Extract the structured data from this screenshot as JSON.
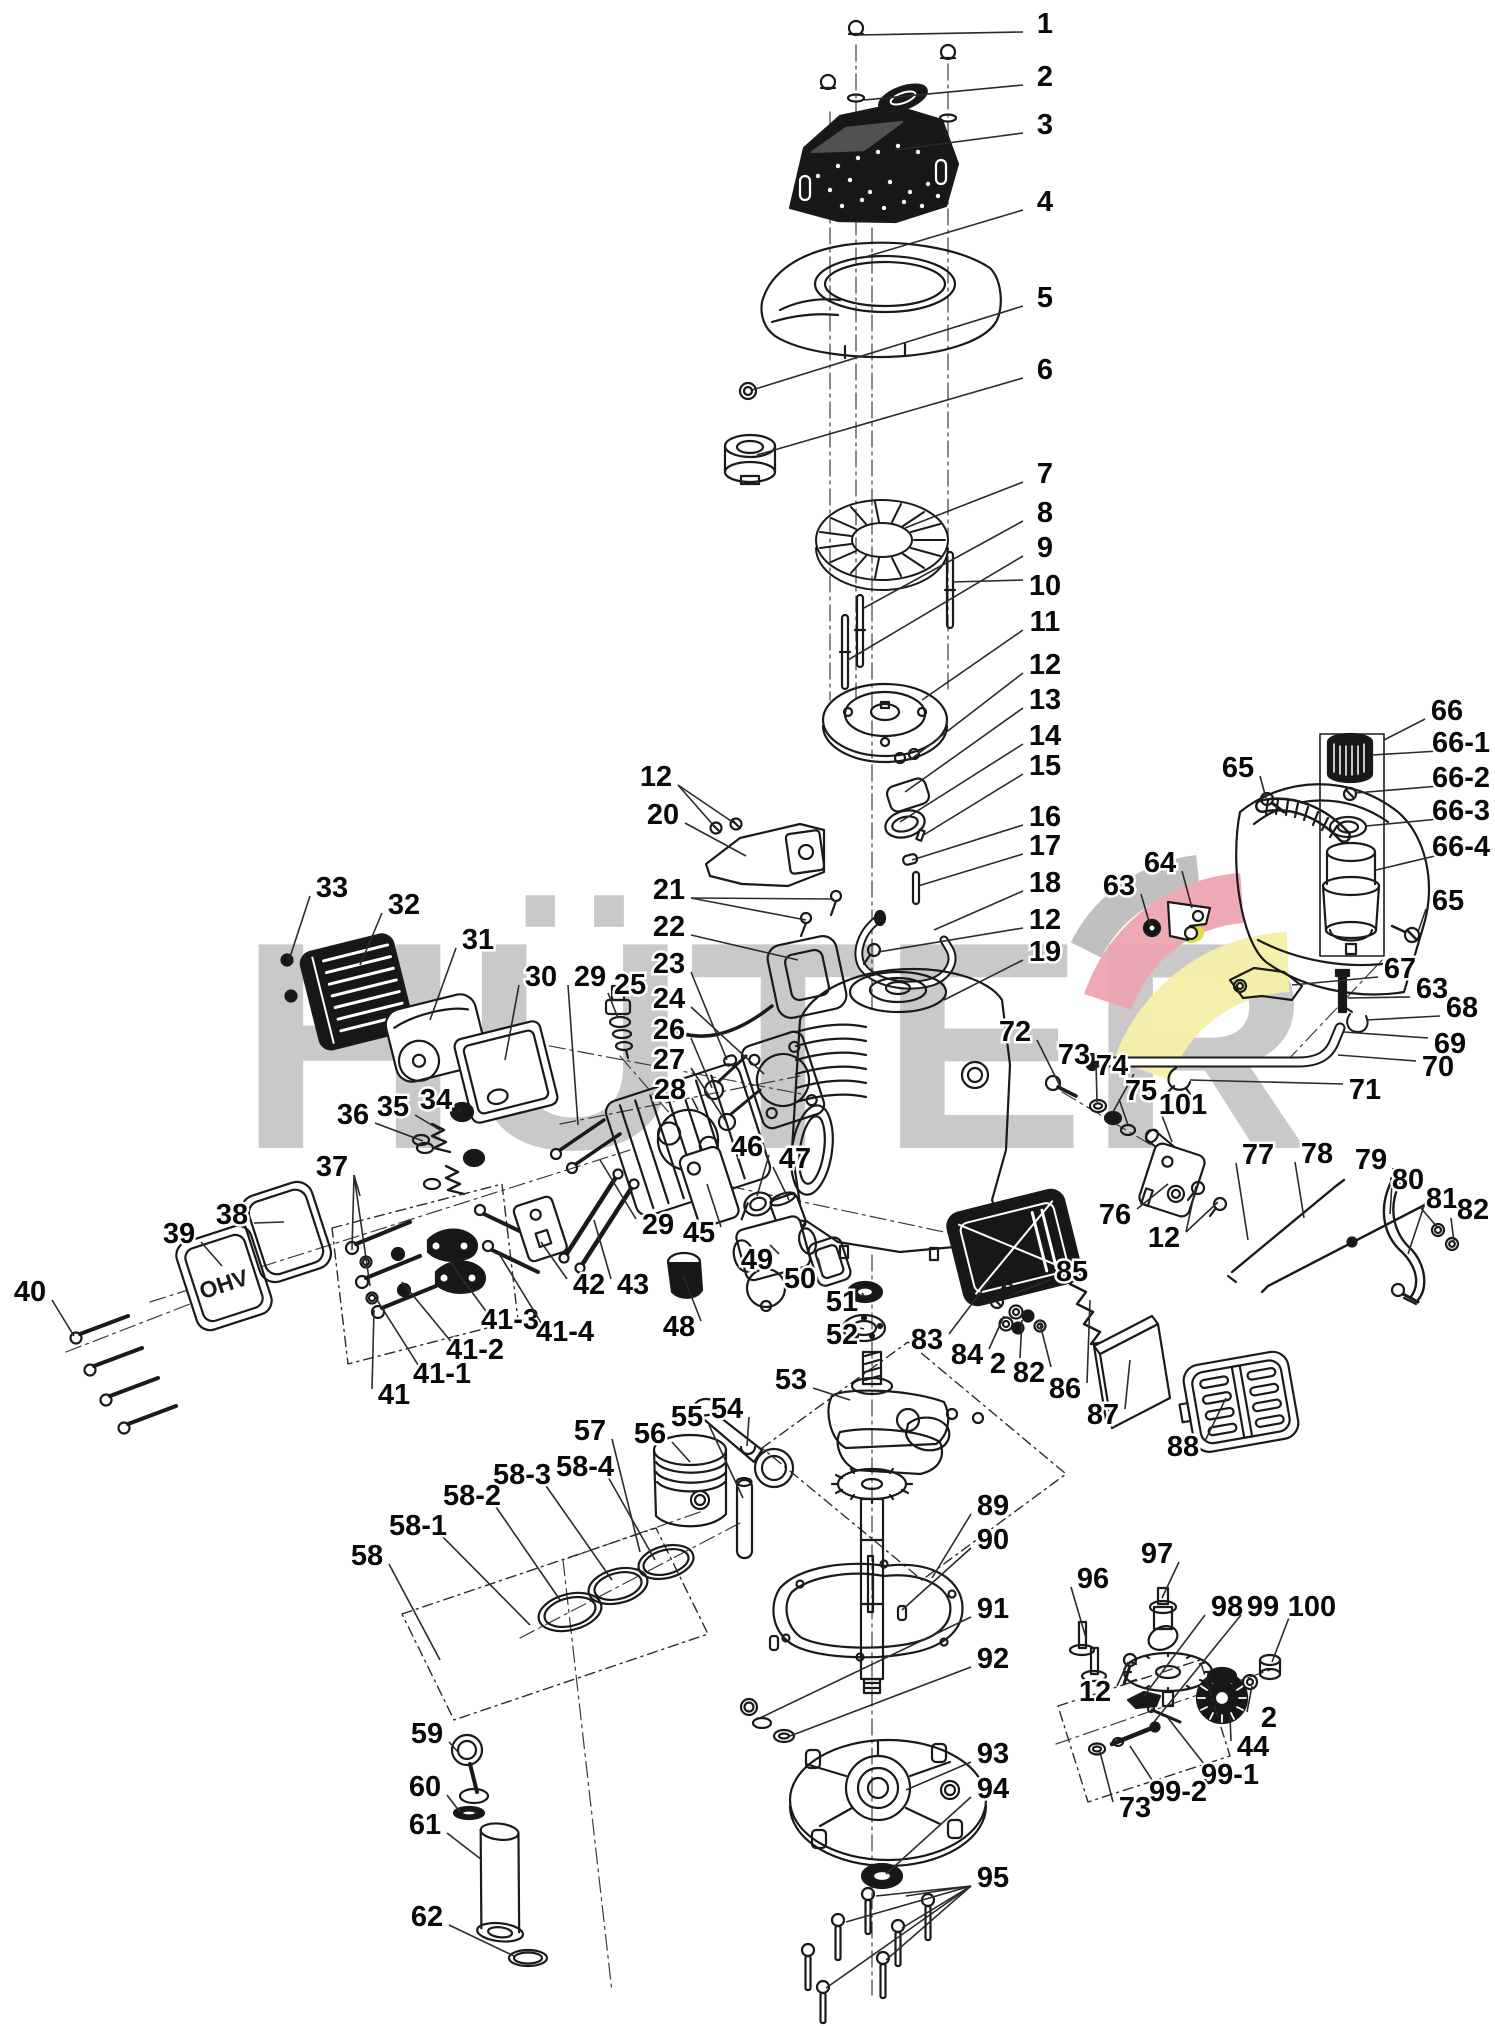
{
  "page": {
    "type": "exploded-parts-diagram",
    "subject": "engine"
  },
  "watermark": {
    "text": "HÜTER",
    "text_color": "#c9c9c9",
    "swoosh_gray": "#bdbdbd",
    "swoosh_red": "#eda6b0",
    "swoosh_yellow": "#f6f0a8",
    "highlight_yellow": "#d9de4b"
  },
  "engraving": {
    "valve_cover": "OHV"
  },
  "style": {
    "ink": "#1a1a1a",
    "background": "#ffffff"
  },
  "labels": [
    {
      "n": "1",
      "x": 1045,
      "y": 22,
      "l": [
        [
          856,
          35
        ]
      ]
    },
    {
      "n": "2",
      "x": 1045,
      "y": 75,
      "l": [
        [
          864,
          100
        ]
      ]
    },
    {
      "n": "3",
      "x": 1045,
      "y": 123,
      "l": [
        [
          895,
          150
        ]
      ]
    },
    {
      "n": "4",
      "x": 1045,
      "y": 200,
      "l": [
        [
          862,
          258
        ]
      ]
    },
    {
      "n": "5",
      "x": 1045,
      "y": 296,
      "l": [
        [
          752,
          390
        ]
      ]
    },
    {
      "n": "6",
      "x": 1045,
      "y": 368,
      "l": [
        [
          757,
          455
        ]
      ]
    },
    {
      "n": "7",
      "x": 1045,
      "y": 472,
      "l": [
        [
          905,
          528
        ]
      ]
    },
    {
      "n": "8",
      "x": 1045,
      "y": 511,
      "l": [
        [
          864,
          608
        ]
      ]
    },
    {
      "n": "9",
      "x": 1045,
      "y": 546,
      "l": [
        [
          848,
          660
        ]
      ]
    },
    {
      "n": "10",
      "x": 1045,
      "y": 584,
      "l": [
        [
          952,
          582
        ]
      ]
    },
    {
      "n": "11",
      "x": 1045,
      "y": 620,
      "l": [
        [
          922,
          700
        ]
      ]
    },
    {
      "n": "12",
      "x": 1045,
      "y": 663,
      "l": [
        [
          910,
          760
        ]
      ]
    },
    {
      "n": "13",
      "x": 1045,
      "y": 698,
      "l": [
        [
          905,
          792
        ]
      ]
    },
    {
      "n": "14",
      "x": 1045,
      "y": 734,
      "l": [
        [
          900,
          822
        ]
      ]
    },
    {
      "n": "15",
      "x": 1045,
      "y": 764,
      "l": [
        [
          922,
          836
        ]
      ]
    },
    {
      "n": "16",
      "x": 1045,
      "y": 815,
      "l": [
        [
          912,
          860
        ]
      ]
    },
    {
      "n": "17",
      "x": 1045,
      "y": 844,
      "l": [
        [
          918,
          886
        ]
      ]
    },
    {
      "n": "18",
      "x": 1045,
      "y": 881,
      "l": [
        [
          934,
          930
        ]
      ]
    },
    {
      "n": "12",
      "x": 1045,
      "y": 918,
      "l": [
        [
          878,
          952
        ]
      ]
    },
    {
      "n": "19",
      "x": 1045,
      "y": 950,
      "l": [
        [
          944,
          1000
        ]
      ]
    },
    {
      "n": "12",
      "x": 656,
      "y": 775,
      "l": [
        [
          714,
          826
        ],
        [
          734,
          823
        ]
      ]
    },
    {
      "n": "20",
      "x": 663,
      "y": 813,
      "l": [
        [
          746,
          856
        ]
      ]
    },
    {
      "n": "21",
      "x": 669,
      "y": 888,
      "l": [
        [
          834,
          899
        ],
        [
          806,
          920
        ]
      ]
    },
    {
      "n": "22",
      "x": 669,
      "y": 925,
      "l": [
        [
          798,
          960
        ]
      ]
    },
    {
      "n": "23",
      "x": 669,
      "y": 962,
      "l": [
        [
          727,
          1060
        ]
      ]
    },
    {
      "n": "24",
      "x": 669,
      "y": 997,
      "l": [
        [
          764,
          1074
        ]
      ]
    },
    {
      "n": "26",
      "x": 669,
      "y": 1028,
      "l": [
        [
          712,
          1088
        ]
      ]
    },
    {
      "n": "27",
      "x": 669,
      "y": 1058,
      "l": [
        [
          725,
          1120
        ]
      ]
    },
    {
      "n": "28",
      "x": 670,
      "y": 1088,
      "l": [
        [
          698,
          1110
        ]
      ]
    },
    {
      "n": "25",
      "x": 630,
      "y": 983,
      "l": [
        [
          618,
          1018
        ]
      ]
    },
    {
      "n": "29",
      "x": 590,
      "y": 975,
      "l": [
        [
          578,
          1125
        ]
      ]
    },
    {
      "n": "30",
      "x": 541,
      "y": 975,
      "l": [
        [
          505,
          1060
        ]
      ]
    },
    {
      "n": "31",
      "x": 478,
      "y": 938,
      "l": [
        [
          430,
          1020
        ]
      ]
    },
    {
      "n": "32",
      "x": 404,
      "y": 903,
      "l": [
        [
          360,
          965
        ]
      ]
    },
    {
      "n": "33",
      "x": 332,
      "y": 886,
      "l": [
        [
          289,
          960
        ]
      ]
    },
    {
      "n": "34",
      "x": 436,
      "y": 1098,
      "l": [
        [
          461,
          1112
        ]
      ]
    },
    {
      "n": "35",
      "x": 393,
      "y": 1105,
      "l": [
        [
          440,
          1130
        ]
      ]
    },
    {
      "n": "36",
      "x": 353,
      "y": 1113,
      "l": [
        [
          423,
          1141
        ]
      ]
    },
    {
      "n": "37",
      "x": 332,
      "y": 1165,
      "l": [
        [
          360,
          1196
        ],
        [
          352,
          1250
        ],
        [
          370,
          1286
        ]
      ]
    },
    {
      "n": "38",
      "x": 232,
      "y": 1213,
      "l": [
        [
          284,
          1222
        ]
      ]
    },
    {
      "n": "39",
      "x": 179,
      "y": 1232,
      "l": [
        [
          222,
          1266
        ]
      ]
    },
    {
      "n": "40",
      "x": 30,
      "y": 1290,
      "l": [
        [
          74,
          1336
        ]
      ]
    },
    {
      "n": "41",
      "x": 394,
      "y": 1393,
      "l": [
        [
          374,
          1310
        ]
      ]
    },
    {
      "n": "41-1",
      "x": 442,
      "y": 1372,
      "l": [
        [
          372,
          1292
        ]
      ]
    },
    {
      "n": "41-2",
      "x": 475,
      "y": 1348,
      "l": [
        [
          402,
          1282
        ]
      ]
    },
    {
      "n": "41-3",
      "x": 510,
      "y": 1318,
      "l": [
        [
          450,
          1262
        ]
      ]
    },
    {
      "n": "41-4",
      "x": 565,
      "y": 1330,
      "l": [
        [
          498,
          1252
        ]
      ]
    },
    {
      "n": "42",
      "x": 589,
      "y": 1283,
      "l": [
        [
          541,
          1242
        ]
      ]
    },
    {
      "n": "43",
      "x": 633,
      "y": 1283,
      "l": [
        [
          594,
          1220
        ]
      ]
    },
    {
      "n": "29",
      "x": 658,
      "y": 1223,
      "l": [
        [
          600,
          1160
        ]
      ]
    },
    {
      "n": "45",
      "x": 699,
      "y": 1231,
      "l": [
        [
          707,
          1184
        ]
      ]
    },
    {
      "n": "46",
      "x": 747,
      "y": 1145,
      "l": [
        [
          757,
          1196
        ]
      ]
    },
    {
      "n": "47",
      "x": 795,
      "y": 1157,
      "l": [
        [
          789,
          1200
        ]
      ]
    },
    {
      "n": "48",
      "x": 679,
      "y": 1325,
      "l": [
        [
          683,
          1275
        ]
      ]
    },
    {
      "n": "49",
      "x": 757,
      "y": 1258,
      "l": [
        [
          770,
          1245
        ]
      ]
    },
    {
      "n": "50",
      "x": 800,
      "y": 1277,
      "l": [
        [
          818,
          1258
        ]
      ]
    },
    {
      "n": "51",
      "x": 842,
      "y": 1300,
      "l": [
        [
          862,
          1293
        ]
      ]
    },
    {
      "n": "52",
      "x": 842,
      "y": 1333,
      "l": [
        [
          860,
          1328
        ]
      ]
    },
    {
      "n": "53",
      "x": 791,
      "y": 1378,
      "l": [
        [
          850,
          1400
        ]
      ]
    },
    {
      "n": "54",
      "x": 727,
      "y": 1407,
      "l": [
        [
          747,
          1446
        ]
      ]
    },
    {
      "n": "55",
      "x": 687,
      "y": 1415,
      "l": [
        [
          743,
          1498
        ]
      ]
    },
    {
      "n": "56",
      "x": 650,
      "y": 1432,
      "l": [
        [
          690,
          1462
        ]
      ]
    },
    {
      "n": "57",
      "x": 590,
      "y": 1429,
      "l": [
        [
          640,
          1552
        ]
      ]
    },
    {
      "n": "58-4",
      "x": 585,
      "y": 1465,
      "l": [
        [
          655,
          1560
        ]
      ]
    },
    {
      "n": "58-3",
      "x": 522,
      "y": 1473,
      "l": [
        [
          612,
          1580
        ]
      ]
    },
    {
      "n": "58-2",
      "x": 472,
      "y": 1494,
      "l": [
        [
          560,
          1600
        ]
      ]
    },
    {
      "n": "58-1",
      "x": 418,
      "y": 1524,
      "l": [
        [
          530,
          1625
        ]
      ]
    },
    {
      "n": "58",
      "x": 367,
      "y": 1554,
      "l": [
        [
          440,
          1660
        ]
      ]
    },
    {
      "n": "59",
      "x": 427,
      "y": 1732,
      "l": [
        [
          458,
          1752
        ]
      ]
    },
    {
      "n": "60",
      "x": 425,
      "y": 1785,
      "l": [
        [
          460,
          1812
        ]
      ]
    },
    {
      "n": "61",
      "x": 425,
      "y": 1823,
      "l": [
        [
          482,
          1860
        ]
      ]
    },
    {
      "n": "62",
      "x": 427,
      "y": 1915,
      "l": [
        [
          514,
          1956
        ]
      ]
    },
    {
      "n": "63",
      "x": 1119,
      "y": 884,
      "l": [
        [
          1150,
          925
        ]
      ]
    },
    {
      "n": "64",
      "x": 1160,
      "y": 861,
      "l": [
        [
          1192,
          908
        ]
      ]
    },
    {
      "n": "65",
      "x": 1238,
      "y": 766,
      "l": [
        [
          1266,
          798
        ]
      ]
    },
    {
      "n": "66",
      "x": 1447,
      "y": 709,
      "l": [
        [
          1384,
          740
        ]
      ]
    },
    {
      "n": "66-1",
      "x": 1461,
      "y": 741,
      "l": [
        [
          1372,
          755
        ]
      ]
    },
    {
      "n": "66-2",
      "x": 1461,
      "y": 776,
      "l": [
        [
          1356,
          793
        ]
      ]
    },
    {
      "n": "66-3",
      "x": 1461,
      "y": 809,
      "l": [
        [
          1366,
          826
        ]
      ]
    },
    {
      "n": "66-4",
      "x": 1461,
      "y": 845,
      "l": [
        [
          1376,
          870
        ]
      ]
    },
    {
      "n": "65",
      "x": 1448,
      "y": 899,
      "l": [
        [
          1418,
          932
        ]
      ]
    },
    {
      "n": "67",
      "x": 1400,
      "y": 967,
      "l": [
        [
          1292,
          985
        ]
      ]
    },
    {
      "n": "63",
      "x": 1432,
      "y": 987,
      "l": [
        [
          1348,
          998
        ]
      ]
    },
    {
      "n": "68",
      "x": 1462,
      "y": 1006,
      "l": [
        [
          1366,
          1020
        ]
      ]
    },
    {
      "n": "69",
      "x": 1450,
      "y": 1042,
      "l": [
        [
          1344,
          1032
        ]
      ]
    },
    {
      "n": "70",
      "x": 1438,
      "y": 1065,
      "l": [
        [
          1338,
          1055
        ]
      ]
    },
    {
      "n": "71",
      "x": 1365,
      "y": 1088,
      "l": [
        [
          1190,
          1080
        ]
      ]
    },
    {
      "n": "72",
      "x": 1015,
      "y": 1030,
      "l": [
        [
          1062,
          1090
        ]
      ]
    },
    {
      "n": "73",
      "x": 1074,
      "y": 1053,
      "l": [
        [
          1097,
          1102
        ]
      ]
    },
    {
      "n": "74",
      "x": 1112,
      "y": 1064,
      "l": [
        [
          1113,
          1112
        ]
      ]
    },
    {
      "n": "75",
      "x": 1141,
      "y": 1089,
      "l": [
        [
          1128,
          1125
        ]
      ]
    },
    {
      "n": "101",
      "x": 1183,
      "y": 1103,
      "l": [
        [
          1172,
          1142
        ]
      ]
    },
    {
      "n": "76",
      "x": 1115,
      "y": 1213,
      "l": [
        [
          1168,
          1184
        ]
      ]
    },
    {
      "n": "12",
      "x": 1164,
      "y": 1236,
      "l": [
        [
          1196,
          1186
        ],
        [
          1218,
          1202
        ]
      ]
    },
    {
      "n": "77",
      "x": 1258,
      "y": 1153,
      "l": [
        [
          1248,
          1240
        ]
      ]
    },
    {
      "n": "78",
      "x": 1317,
      "y": 1152,
      "l": [
        [
          1304,
          1218
        ]
      ]
    },
    {
      "n": "79",
      "x": 1371,
      "y": 1158,
      "l": [
        [
          1390,
          1214
        ]
      ]
    },
    {
      "n": "80",
      "x": 1408,
      "y": 1178,
      "l": [
        [
          1408,
          1254
        ]
      ]
    },
    {
      "n": "81",
      "x": 1442,
      "y": 1197,
      "l": [
        [
          1438,
          1228
        ]
      ]
    },
    {
      "n": "82",
      "x": 1473,
      "y": 1208,
      "l": [
        [
          1454,
          1242
        ]
      ]
    },
    {
      "n": "85",
      "x": 1072,
      "y": 1270,
      "l": [
        [
          1014,
          1294
        ]
      ]
    },
    {
      "n": "84",
      "x": 967,
      "y": 1353,
      "l": [
        [
          1004,
          1316
        ]
      ]
    },
    {
      "n": "2",
      "x": 998,
      "y": 1362,
      "l": [
        [
          1022,
          1320
        ]
      ]
    },
    {
      "n": "82",
      "x": 1029,
      "y": 1371,
      "l": [
        [
          1040,
          1324
        ]
      ]
    },
    {
      "n": "86",
      "x": 1065,
      "y": 1387,
      "l": [
        [
          1090,
          1300
        ]
      ]
    },
    {
      "n": "87",
      "x": 1103,
      "y": 1413,
      "l": [
        [
          1130,
          1360
        ]
      ]
    },
    {
      "n": "88",
      "x": 1183,
      "y": 1445,
      "l": [
        [
          1226,
          1398
        ]
      ]
    },
    {
      "n": "83",
      "x": 927,
      "y": 1338,
      "l": [
        [
          990,
          1280
        ]
      ]
    },
    {
      "n": "89",
      "x": 993,
      "y": 1504,
      "l": [
        [
          932,
          1578
        ]
      ]
    },
    {
      "n": "90",
      "x": 993,
      "y": 1538,
      "l": [
        [
          902,
          1610
        ]
      ]
    },
    {
      "n": "91",
      "x": 993,
      "y": 1607,
      "l": [
        [
          760,
          1718
        ]
      ]
    },
    {
      "n": "92",
      "x": 993,
      "y": 1657,
      "l": [
        [
          790,
          1736
        ]
      ]
    },
    {
      "n": "93",
      "x": 993,
      "y": 1752,
      "l": [
        [
          906,
          1790
        ]
      ]
    },
    {
      "n": "94",
      "x": 993,
      "y": 1787,
      "l": [
        [
          886,
          1874
        ]
      ]
    },
    {
      "n": "95",
      "x": 993,
      "y": 1876,
      "l": [
        [
          906,
          1896
        ],
        [
          876,
          1896
        ],
        [
          846,
          1922
        ],
        [
          902,
          1928
        ],
        [
          886,
          1960
        ],
        [
          826,
          1988
        ]
      ]
    },
    {
      "n": "96",
      "x": 1093,
      "y": 1577,
      "l": [
        [
          1086,
          1638
        ]
      ]
    },
    {
      "n": "97",
      "x": 1157,
      "y": 1552,
      "l": [
        [
          1162,
          1598
        ]
      ]
    },
    {
      "n": "12",
      "x": 1095,
      "y": 1690,
      "l": [
        [
          1128,
          1662
        ]
      ]
    },
    {
      "n": "98",
      "x": 1227,
      "y": 1605,
      "l": [
        [
          1144,
          1696
        ]
      ]
    },
    {
      "n": "99",
      "x": 1263,
      "y": 1605,
      "l": [
        [
          1154,
          1722
        ]
      ]
    },
    {
      "n": "100",
      "x": 1312,
      "y": 1605,
      "l": [
        [
          1272,
          1662
        ]
      ]
    },
    {
      "n": "2",
      "x": 1269,
      "y": 1716,
      "l": [
        [
          1252,
          1686
        ]
      ]
    },
    {
      "n": "44",
      "x": 1253,
      "y": 1745,
      "l": [
        [
          1230,
          1716
        ]
      ]
    },
    {
      "n": "99-1",
      "x": 1230,
      "y": 1773,
      "l": [
        [
          1168,
          1718
        ]
      ]
    },
    {
      "n": "99-2",
      "x": 1178,
      "y": 1790,
      "l": [
        [
          1130,
          1746
        ]
      ]
    },
    {
      "n": "73",
      "x": 1135,
      "y": 1806,
      "l": [
        [
          1100,
          1752
        ]
      ]
    }
  ]
}
